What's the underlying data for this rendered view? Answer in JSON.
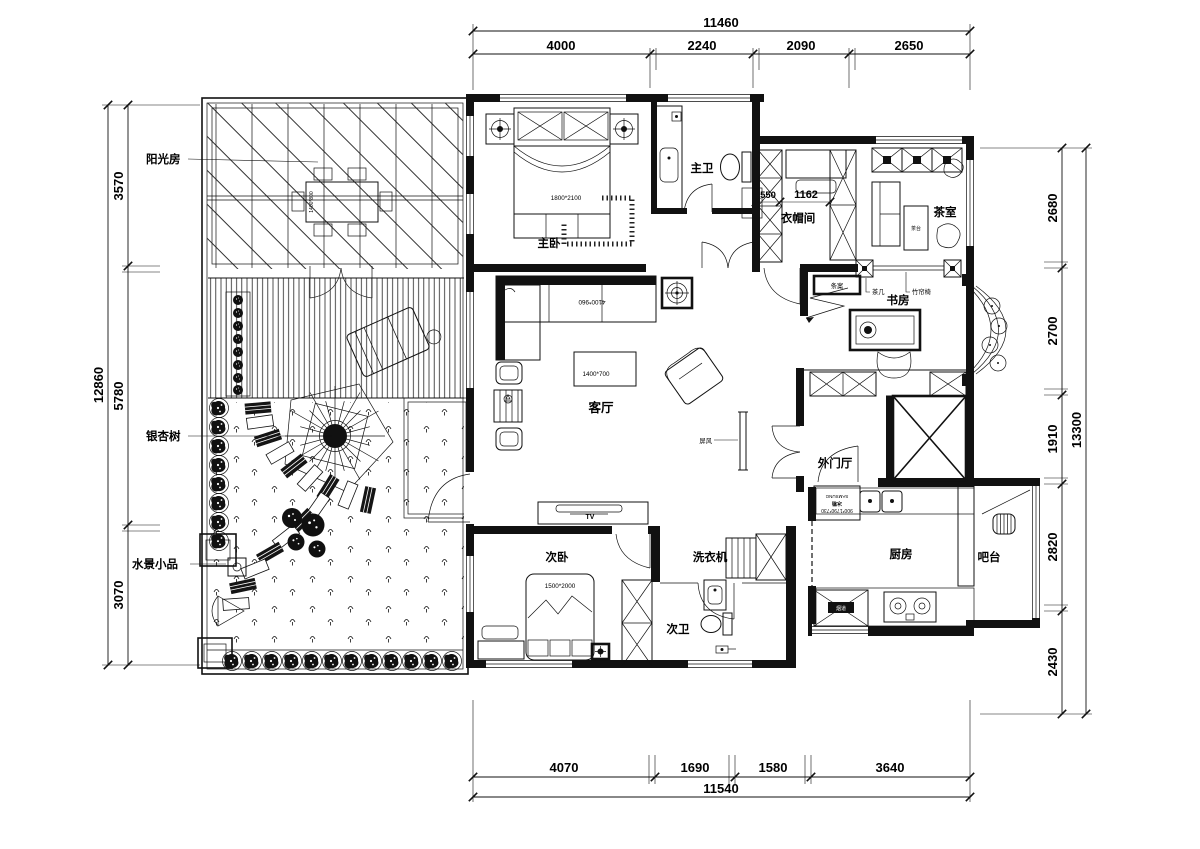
{
  "dimensions": {
    "top": {
      "total": "11460",
      "segments": [
        "4000",
        "2240",
        "2090",
        "2650"
      ]
    },
    "bottom": {
      "total": "11540",
      "segments": [
        "4070",
        "1690",
        "1580",
        "3640"
      ]
    },
    "left": {
      "total": "12860",
      "segments": [
        "3570",
        "5780",
        "3070"
      ]
    },
    "right": {
      "total": "13300",
      "segments": [
        "2680",
        "2700",
        "1910",
        "2820",
        "2430"
      ]
    }
  },
  "rooms": {
    "sunroom": "阳光房",
    "ginkgo_tree": "银杏树",
    "water_feature": "水景小品",
    "master_bedroom": "主卧",
    "master_bath": "主卫",
    "closet": "衣帽间",
    "tea_room": "茶室",
    "study": "书房",
    "living_room": "客厅",
    "foyer": "外门厅",
    "kitchen": "厨房",
    "bar": "吧台",
    "second_bedroom": "次卧",
    "second_bath": "次卫",
    "washer": "洗衣机"
  },
  "furniture": {
    "master_bed_size": "1800*2100",
    "second_bed_size": "1500*2000",
    "sofa_size": "4100*960",
    "coffee_table_size": "1400*700",
    "dining_table_size": "1400*800",
    "closet_dim_a": "550",
    "closet_dim_b": "1162",
    "tea_table": "茶台",
    "console_table": "条案",
    "tea_side_table": "茶几",
    "bamboo_screen": "竹帘椅",
    "tv": "TV",
    "screen": "屏风",
    "flue": "烟道",
    "fridge_size": "900*1790*730",
    "fridge_name": "冰箱",
    "fridge_brand": "SAMSUNG"
  }
}
